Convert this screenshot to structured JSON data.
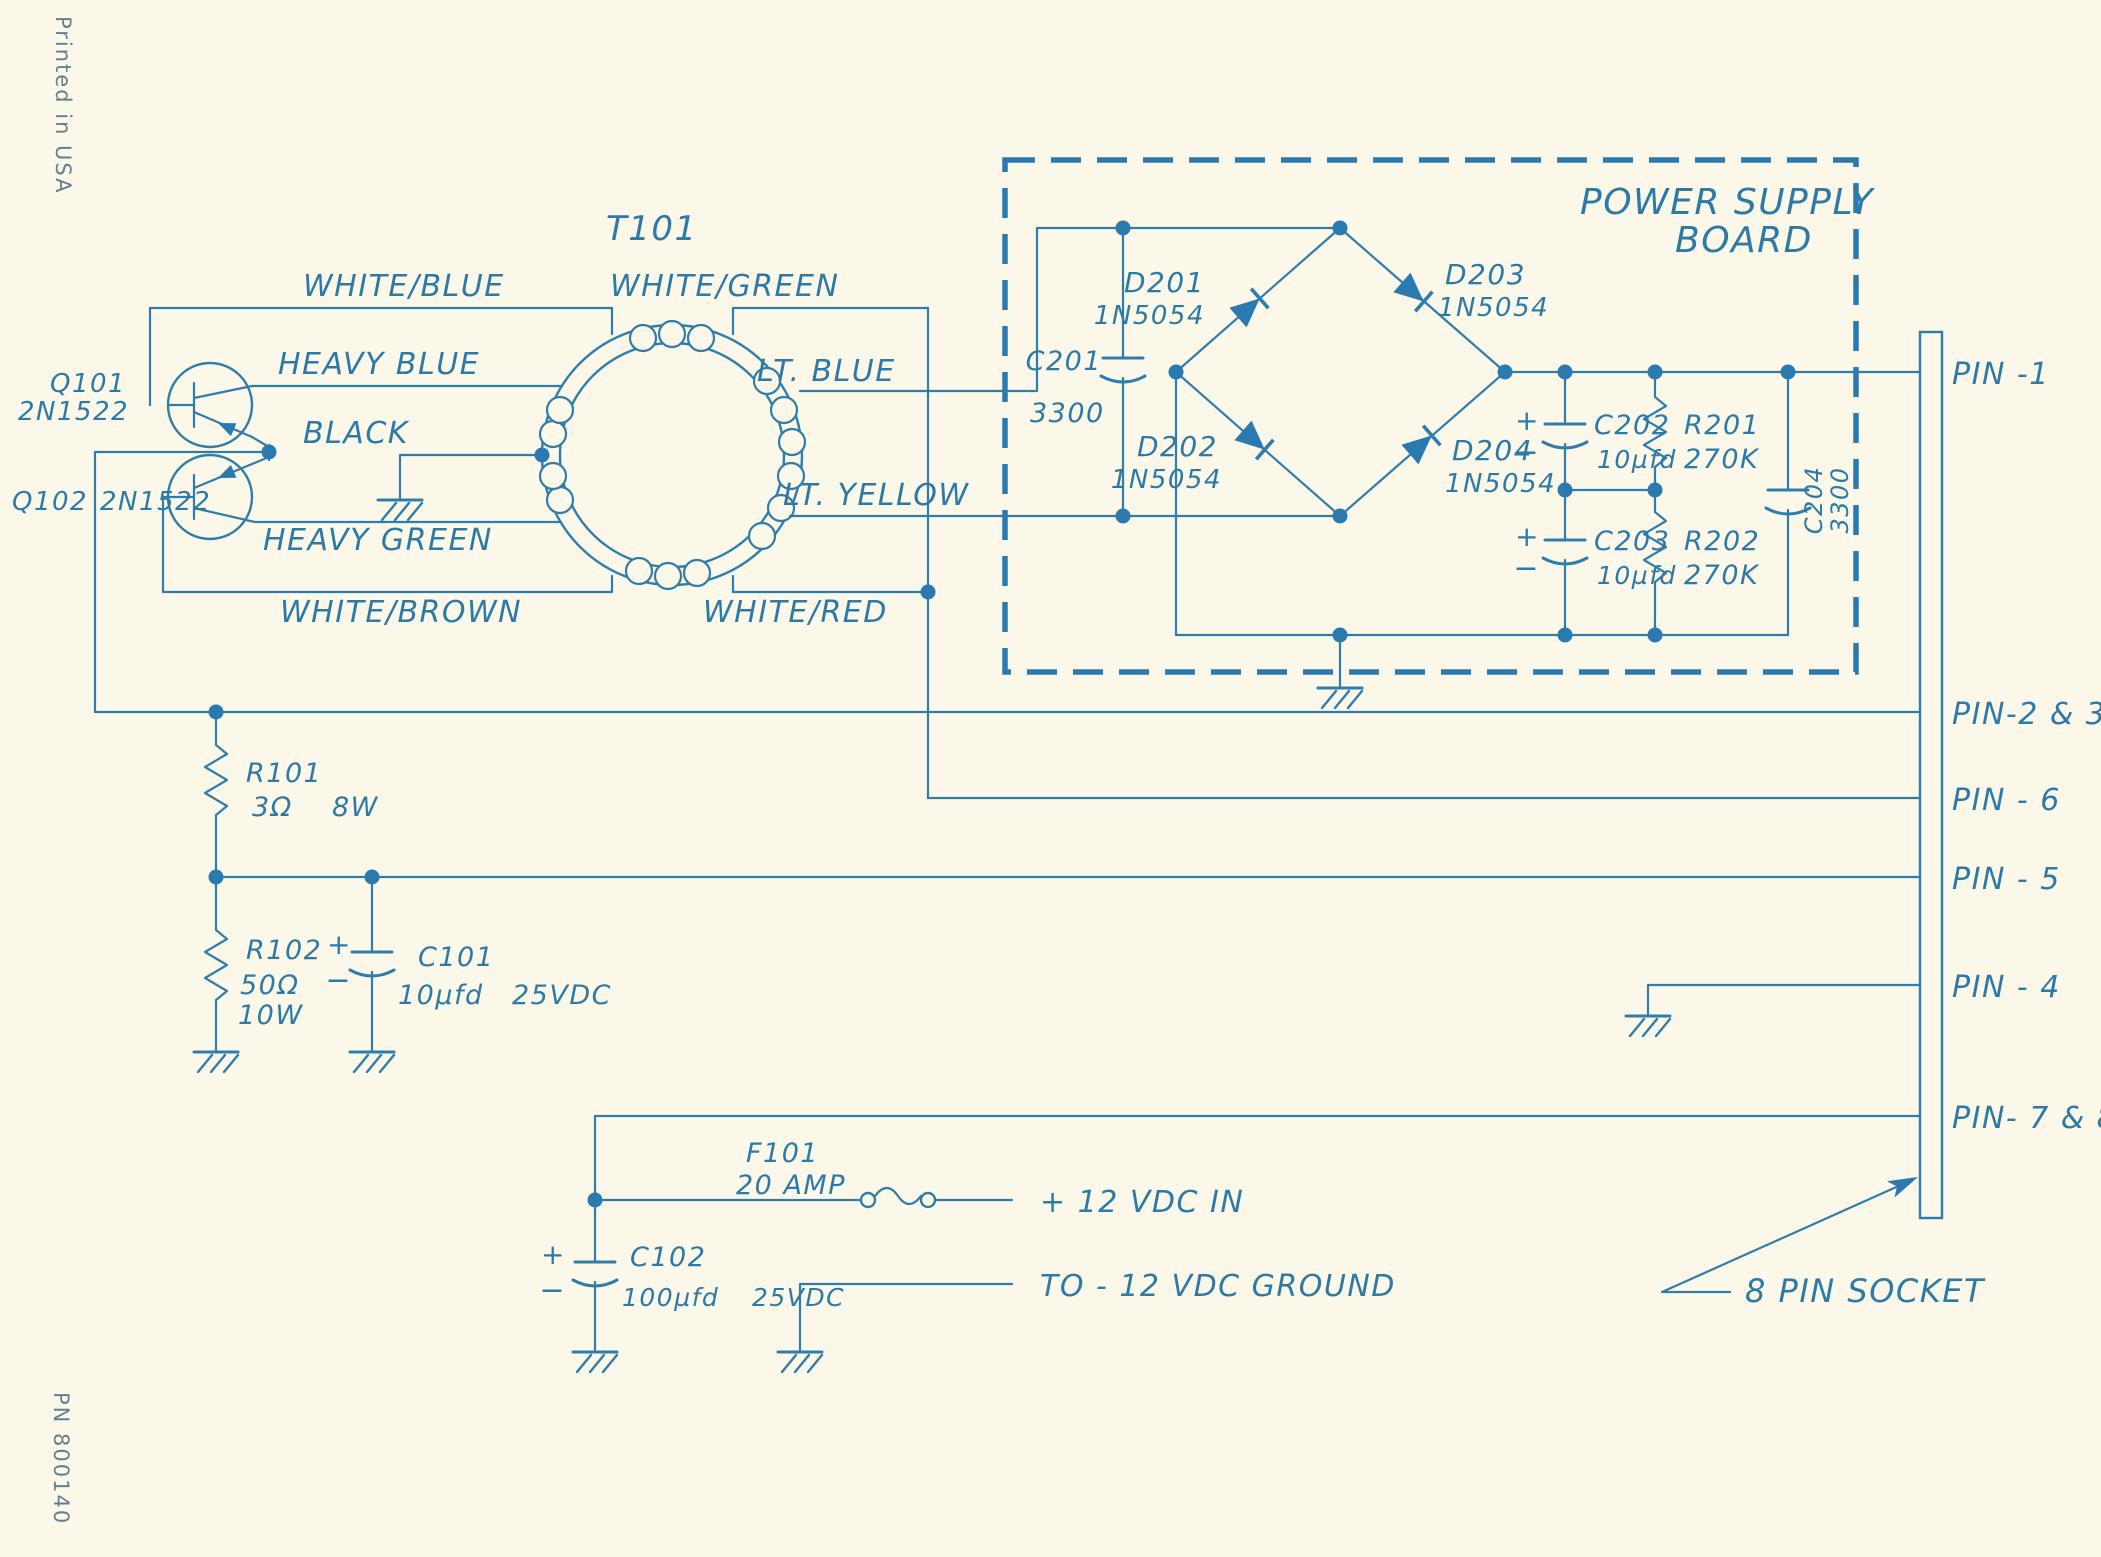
{
  "meta": {
    "printed_in": "Printed in USA",
    "part_number": "PN 800140"
  },
  "board": {
    "title1": "POWER SUPPLY",
    "title2": "BOARD"
  },
  "transformer": {
    "ref": "T101"
  },
  "transistors": {
    "q101": {
      "ref": "Q101",
      "part": "2N1522"
    },
    "q102": {
      "ref": "Q102",
      "part": "2N1522"
    }
  },
  "wires": {
    "white_blue": "WHITE/BLUE",
    "white_green": "WHITE/GREEN",
    "heavy_blue": "HEAVY BLUE",
    "black": "BLACK",
    "lt_blue": "LT. BLUE",
    "lt_yellow": "LT. YELLOW",
    "heavy_green": "HEAVY GREEN",
    "white_brown": "WHITE/BROWN",
    "white_red": "WHITE/RED"
  },
  "resistors": {
    "r101": {
      "ref": "R101",
      "value": "3Ω",
      "power": "8W"
    },
    "r102": {
      "ref": "R102",
      "value": "50Ω",
      "power": "10W"
    },
    "r201": {
      "ref": "R201",
      "value": "270K"
    },
    "r202": {
      "ref": "R202",
      "value": "270K"
    }
  },
  "capacitors": {
    "c101": {
      "ref": "C101",
      "value": "10µfd",
      "rating": "25VDC"
    },
    "c102": {
      "ref": "C102",
      "value": "100µfd",
      "rating": "25VDC"
    },
    "c201": {
      "ref": "C201",
      "value": "3300"
    },
    "c202": {
      "ref": "C202",
      "value": "10µfd"
    },
    "c203": {
      "ref": "C203",
      "value": "10µfd"
    },
    "c204": {
      "ref": "C204",
      "value": "3300"
    }
  },
  "diodes": {
    "d201": {
      "ref": "D201",
      "part": "1N5054"
    },
    "d202": {
      "ref": "D202",
      "part": "1N5054"
    },
    "d203": {
      "ref": "D203",
      "part": "1N5054"
    },
    "d204": {
      "ref": "D204",
      "part": "1N5054"
    }
  },
  "fuse": {
    "ref": "F101",
    "value": "20 AMP"
  },
  "pins": {
    "pin1": "PIN -1",
    "pin23": "PIN-2 & 3",
    "pin6": "PIN - 6",
    "pin5": "PIN - 5",
    "pin4": "PIN - 4",
    "pin78": "PIN- 7 & 8"
  },
  "socket": {
    "label": "8 PIN SOCKET"
  },
  "io": {
    "plus12": "+ 12  VDC  IN",
    "minus12": "TO - 12 VDC  GROUND"
  },
  "polarity": {
    "plus": "+",
    "minus": "−"
  }
}
